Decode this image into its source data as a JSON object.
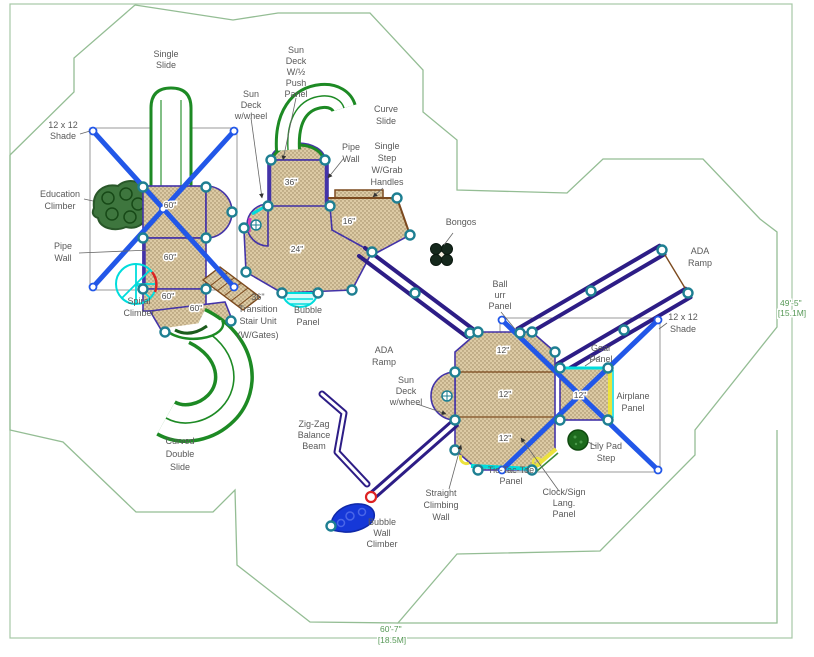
{
  "drawing": {
    "type": "playground-equipment-plan",
    "colors": {
      "boundary_green": "#94bd94",
      "border_green": "#a6c8a6",
      "deck_fill": "#dccaa4",
      "deck_dots": "#99855f",
      "deck_outline_purple": "#4333a8",
      "ramp_purple": "#2d1d86",
      "shade_post_blue": "#2257e8",
      "post_node_teal": "#1e7f92",
      "slide_green": "#1d8a24",
      "climber_dark_green": "#2e6b2e",
      "accent_cyan": "#00dcdc",
      "accent_magenta": "#e23cc0",
      "accent_yellow": "#ece23c",
      "accent_red": "#dd2222",
      "bubble_wall_blue": "#1638d8",
      "stair_brown": "#7c4a1e",
      "label_gray": "#595959",
      "dimension_green": "#579957"
    },
    "labels": [
      {
        "id": "single-slide",
        "lines": [
          "Single",
          "Slide"
        ],
        "x": 166,
        "y": 57,
        "lh": 11
      },
      {
        "id": "shade-left",
        "lines": [
          "12 x 12",
          "Shade"
        ],
        "x": 63,
        "y": 128,
        "lh": 11
      },
      {
        "id": "sun-deck-wheel-top",
        "lines": [
          "Sun",
          "Deck",
          "w/wheel"
        ],
        "x": 251,
        "y": 97,
        "lh": 11
      },
      {
        "id": "sun-deck-push-panel",
        "lines": [
          "Sun",
          "Deck",
          "W/½",
          "Push",
          "Panel"
        ],
        "x": 296,
        "y": 53,
        "lh": 11
      },
      {
        "id": "curve-slide",
        "lines": [
          "Curve",
          "Slide"
        ],
        "x": 386,
        "y": 112,
        "lh": 12
      },
      {
        "id": "pipe-wall-right",
        "lines": [
          "Pipe",
          "Wall"
        ],
        "x": 351,
        "y": 150,
        "lh": 12
      },
      {
        "id": "single-step-grab-handles",
        "lines": [
          "Single",
          "Step",
          "W/Grab",
          "Handles"
        ],
        "x": 387,
        "y": 149,
        "lh": 12
      },
      {
        "id": "bongos",
        "lines": [
          "Bongos"
        ],
        "x": 461,
        "y": 225,
        "lh": 11
      },
      {
        "id": "education-climber",
        "lines": [
          "Education",
          "Climber"
        ],
        "x": 60,
        "y": 197,
        "lh": 12
      },
      {
        "id": "pipe-wall-left",
        "lines": [
          "Pipe",
          "Wall"
        ],
        "x": 63,
        "y": 249,
        "lh": 12
      },
      {
        "id": "spiral-climber",
        "lines": [
          "Spiral",
          "Climber"
        ],
        "x": 139,
        "y": 304,
        "lh": 12
      },
      {
        "id": "transition-stair-unit",
        "lines": [
          "36\"",
          "Transition",
          "Stair Unit"
        ],
        "x": 258,
        "y": 300,
        "lh": 12
      },
      {
        "id": "transition-stair-gates",
        "lines": [
          "(W/Gates)"
        ],
        "x": 258,
        "y": 338,
        "size": 6.5
      },
      {
        "id": "bubble-panel",
        "lines": [
          "Bubble",
          "Panel"
        ],
        "x": 308,
        "y": 313,
        "lh": 12
      },
      {
        "id": "ada-ramp-center",
        "lines": [
          "ADA",
          "Ramp"
        ],
        "x": 384,
        "y": 353,
        "lh": 12
      },
      {
        "id": "ball-urr-panel",
        "lines": [
          "Ball",
          "urr",
          "Panel"
        ],
        "x": 500,
        "y": 287,
        "lh": 11
      },
      {
        "id": "ada-ramp-right",
        "lines": [
          "ADA",
          "Ramp"
        ],
        "x": 700,
        "y": 254,
        "lh": 12
      },
      {
        "id": "shade-right",
        "lines": [
          "12 x 12",
          "Shade"
        ],
        "x": 683,
        "y": 320,
        "lh": 12
      },
      {
        "id": "gear-panel",
        "lines": [
          "Gear",
          "Panel"
        ],
        "x": 601,
        "y": 351,
        "lh": 11
      },
      {
        "id": "airplane-panel",
        "lines": [
          "Airplane",
          "Panel"
        ],
        "x": 633,
        "y": 399,
        "lh": 12
      },
      {
        "id": "lily-pad-step",
        "lines": [
          "Lily Pad",
          "Step"
        ],
        "x": 606,
        "y": 449,
        "lh": 12
      },
      {
        "id": "tic-tac-toe-panel",
        "lines": [
          "Tic-Tac-Toe",
          "Panel"
        ],
        "x": 511,
        "y": 473,
        "lh": 11
      },
      {
        "id": "clock-sign-lang-panel",
        "lines": [
          "Clock/Sign",
          "Lang.",
          "Panel"
        ],
        "x": 564,
        "y": 495,
        "lh": 11
      },
      {
        "id": "sun-deck-wheel-bottom",
        "lines": [
          "Sun",
          "Deck",
          "w/wheel"
        ],
        "x": 406,
        "y": 383,
        "lh": 11
      },
      {
        "id": "zig-zag-balance-beam",
        "lines": [
          "Zig-Zag",
          "Balance",
          "Beam"
        ],
        "x": 314,
        "y": 427,
        "lh": 11
      },
      {
        "id": "straight-climbing-wall",
        "lines": [
          "Straight",
          "Climbing",
          "Wall"
        ],
        "x": 441,
        "y": 496,
        "lh": 12
      },
      {
        "id": "bubble-wall-climber",
        "lines": [
          "Bubble",
          "Wall",
          "Climber"
        ],
        "x": 382,
        "y": 525,
        "lh": 11
      },
      {
        "id": "curved-double-slide",
        "lines": [
          "Curved",
          "Double",
          "Slide"
        ],
        "x": 180,
        "y": 444,
        "lh": 13
      }
    ],
    "deck_labels": [
      {
        "text": "60\"",
        "x": 170,
        "y": 208
      },
      {
        "text": "60\"",
        "x": 170,
        "y": 260
      },
      {
        "text": "60\"",
        "x": 168,
        "y": 299
      },
      {
        "text": "60\"",
        "x": 196,
        "y": 311
      },
      {
        "text": "36\"",
        "x": 291,
        "y": 185
      },
      {
        "text": "24\"",
        "x": 297,
        "y": 252
      },
      {
        "text": "16\"",
        "x": 349,
        "y": 224
      },
      {
        "text": "12\"",
        "x": 503,
        "y": 353
      },
      {
        "text": "12\"",
        "x": 505,
        "y": 397
      },
      {
        "text": "12\"",
        "x": 580,
        "y": 398
      },
      {
        "text": "12\"",
        "x": 505,
        "y": 441
      }
    ],
    "dimensions": {
      "right": {
        "lines": [
          "49'-5\"",
          "[15.1M]"
        ]
      },
      "bottom": {
        "lines": [
          "60'-7\"",
          "[18.5M]"
        ]
      }
    }
  }
}
